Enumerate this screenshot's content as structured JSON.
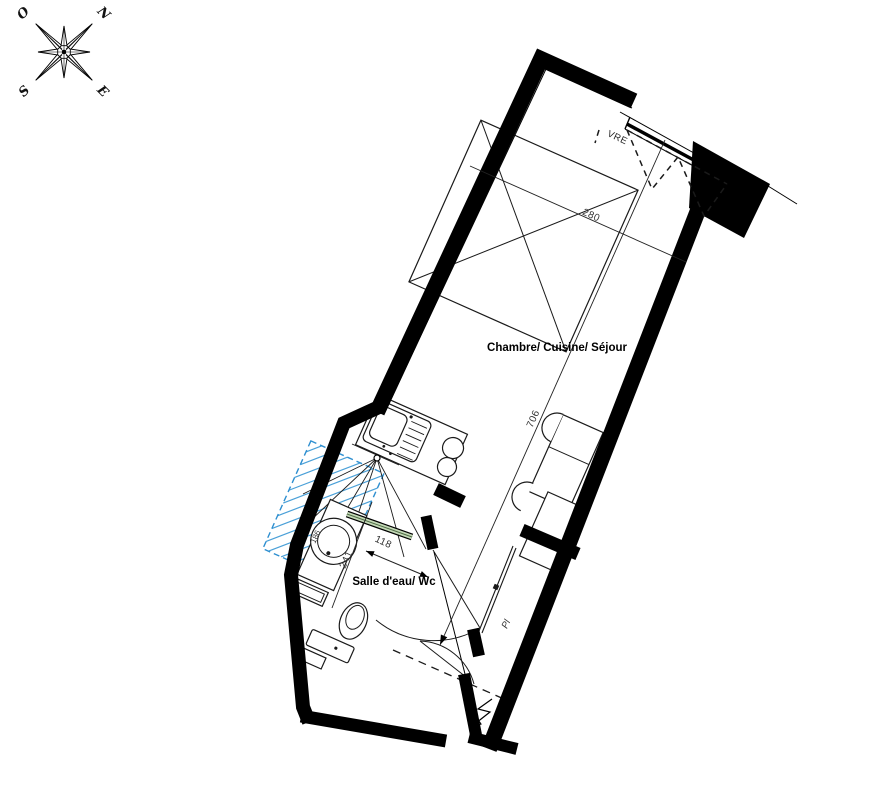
{
  "compass": {
    "north": "N",
    "west": "O",
    "south": "S",
    "east": "E"
  },
  "labels": {
    "main_room": "Chambre/ Cuisine/ Séjour",
    "bathroom": "Salle d'eau/ Wc",
    "closet": "Pl",
    "window": "VRE"
  },
  "dimensions": {
    "room_width": "280",
    "room_length": "706",
    "shower_door_width": "118",
    "bathroom_length": "241",
    "basin_width": "186"
  },
  "colors": {
    "line": "#000000",
    "dimension_text": "#333333",
    "shower_hatch": "#4aa0d8",
    "shower_dashed": "#2e8fd0",
    "door_glass_green": "#c3d8b6"
  }
}
